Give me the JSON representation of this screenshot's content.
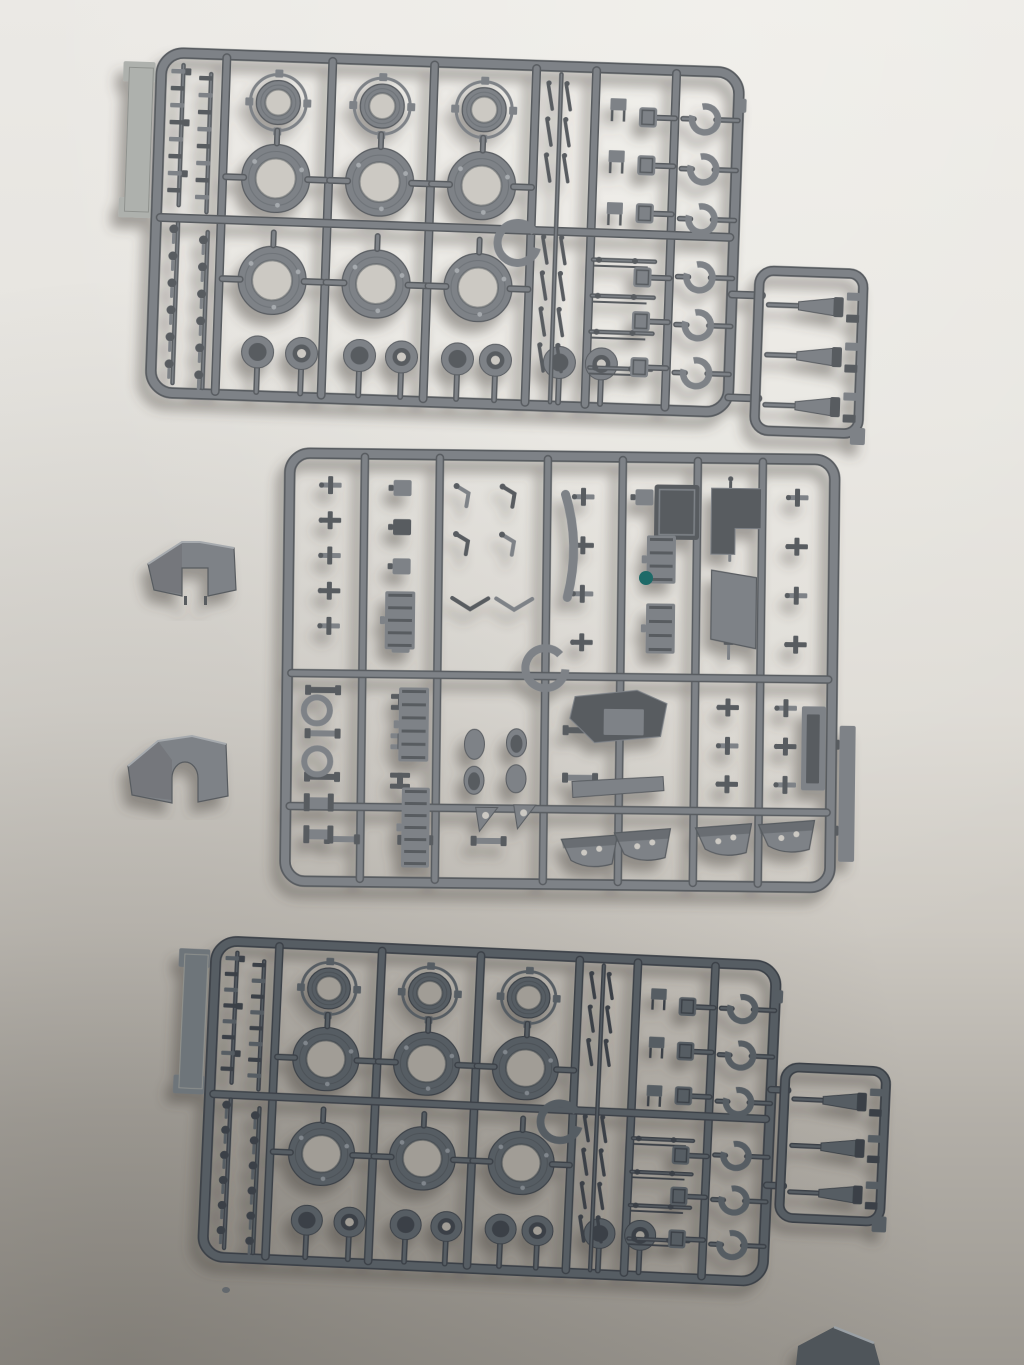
{
  "scene": {
    "subject": "photo of three gray injection-molded model-kit sprues with wheels and small parts, plus two loose mudguard parts, on light paper that darkens toward the bottom",
    "canvas": {
      "width": 1024,
      "height": 1365
    },
    "background": {
      "stops": [
        [
          0,
          "#ebe9e5"
        ],
        [
          0.3,
          "#e6e4df"
        ],
        [
          0.52,
          "#dddad4"
        ],
        [
          0.68,
          "#ccc8c1"
        ],
        [
          0.82,
          "#b3afa8"
        ],
        [
          1,
          "#9c9891"
        ]
      ],
      "corner_shade": "rgba(50,47,42,0.25)",
      "top_light": "rgba(255,255,250,0.30)"
    },
    "palettes": {
      "plastic": {
        "mid": "#7e8287",
        "dark": "#585c61",
        "light": "#a6aaae",
        "hole": "#ccc9c3",
        "tag": "#aeb1ad"
      },
      "plastic_dark": {
        "mid": "#575d63",
        "dark": "#3b4147",
        "light": "#80868c",
        "hole": "#a19d96",
        "tag": "#6e747a"
      }
    },
    "accent_dot": {
      "color": "#1e6a68",
      "cx": 646,
      "cy": 578,
      "r": 7
    },
    "wheel_layout": {
      "frame": [
        12,
        0,
        578,
        340
      ],
      "rx": 22,
      "tag": {
        "x": -20,
        "y": 10,
        "w": 24,
        "h": 156
      },
      "v_runners": [
        77,
        183,
        285,
        387,
        447,
        527
      ],
      "h_runner_y": 165,
      "wheel_cols": [
        130,
        234,
        336
      ],
      "row1": {
        "cy": 46,
        "ro": 22,
        "ri": 13,
        "flange": 28
      },
      "row2": {
        "cy": 122,
        "ro": 34,
        "ri": 20
      },
      "row3": {
        "cy": 224,
        "ro": 34,
        "ri": 20
      },
      "cups": {
        "cy": 296,
        "r": 16,
        "xs": [
          118,
          162,
          220,
          262,
          318,
          356,
          420,
          462
        ]
      },
      "left_bars": {
        "y0": 16,
        "rows": 8,
        "dy": 17
      },
      "ball_joints": {
        "y0": 176,
        "rows": 6,
        "dy": 27
      },
      "lever_rows": [
        30,
        66,
        102,
        184,
        220,
        256,
        292
      ],
      "stand_rows": [
        40,
        92,
        144
      ],
      "rod_rows": [
        192,
        228,
        264,
        300
      ],
      "boxes": {
        "cx": 500,
        "cys": [
          48,
          96,
          144,
          208,
          252,
          298
        ],
        "w": 18,
        "h": 20
      },
      "hubs": {
        "cx": 557,
        "cys": [
          48,
          98,
          148,
          206,
          254,
          302
        ],
        "r": 13
      },
      "center_ring": {
        "cx": 374,
        "cy": 178,
        "r": 20
      }
    },
    "detail_layout": {
      "frame": [
        0,
        0,
        545,
        428
      ],
      "rx": 20,
      "v_runners": [
        75,
        150,
        258,
        333,
        408,
        473
      ],
      "h_runners": [
        220,
        353
      ],
      "scatter": [
        [
          10,
          14,
          62,
          176,
          5,
          1,
          "t"
        ],
        [
          6,
          215,
          60,
          130,
          3,
          1,
          "bar"
        ],
        [
          84,
          14,
          58,
          196,
          5,
          1,
          "plate"
        ],
        [
          84,
          228,
          60,
          118,
          3,
          1,
          "clamp"
        ],
        [
          158,
          16,
          92,
          96,
          2,
          2,
          "arm"
        ],
        [
          160,
          120,
          88,
          58,
          1,
          2,
          "vee"
        ],
        [
          262,
          16,
          64,
          194,
          4,
          1,
          "t"
        ],
        [
          262,
          250,
          64,
          95,
          2,
          1,
          "bar"
        ],
        [
          340,
          14,
          60,
          52,
          1,
          2,
          "plate"
        ],
        [
          412,
          14,
          58,
          196,
          4,
          1,
          "gun"
        ],
        [
          478,
          14,
          60,
          196,
          4,
          1,
          "t"
        ],
        [
          412,
          230,
          116,
          115,
          3,
          2,
          "t"
        ],
        [
          20,
          358,
          220,
          55,
          1,
          3,
          "bar"
        ]
      ],
      "parts": {
        "square_box": [
          365,
          27,
          45,
          55
        ],
        "l_plate": "M422,30 h50 v40 h-26 v26 h-24 z",
        "strip": "M276,38 q16,50 3,103",
        "ladders": [
          [
            97,
            137,
            30,
            58
          ],
          [
            358,
            78,
            29,
            48
          ],
          [
            358,
            146,
            29,
            50
          ],
          [
            112,
            233,
            30,
            74
          ],
          [
            116,
            333,
            28,
            80
          ]
        ],
        "hull_side": "423,112 468,119 468,190 423,181",
        "hex_plate": "288,240 350,233 380,246 374,279 308,286 283,262",
        "hex_inner": [
          317,
          252,
          40,
          26
        ],
        "bar_long": "286,325 377,319 378,333 287,341",
        "open_box": [
          515,
          247,
          24,
          84
        ],
        "open_box_slot": [
          520,
          255,
          13,
          69
        ],
        "rail": [
          553,
          266,
          16,
          136
        ],
        "ring_center": [
          258,
          212,
          20
        ],
        "rings_left": [
          [
            30,
            257,
            13
          ],
          [
            31,
            308,
            13
          ]
        ],
        "domes": [
          [
            188,
            289,
            10,
            15,
            0
          ],
          [
            230,
            287,
            10,
            14,
            1
          ],
          [
            188,
            325,
            10,
            14,
            1
          ],
          [
            230,
            323,
            10,
            14,
            0
          ]
        ],
        "gussets": [
          "190,352 212,352 194,376",
          "228,349 250,349 232,373"
        ],
        "fenders": [
          [
            306,
            395
          ],
          [
            359,
            388
          ],
          [
            440,
            382
          ],
          [
            503,
            378
          ]
        ],
        "spools": [
          [
            18,
            340,
            30,
            18
          ],
          [
            18,
            372,
            30,
            18
          ]
        ]
      }
    },
    "sprues": [
      {
        "name": "wheel-sprue-top",
        "type": "wheel",
        "tx": 150,
        "ty": 52,
        "rot": 2.0,
        "sx": 1,
        "sy": 1,
        "palette": "plastic",
        "satellite": {
          "x": 617,
          "y": 197,
          "w": 104,
          "h": 160
        }
      },
      {
        "name": "detail-sprue-middle",
        "type": "detail",
        "tx": 290,
        "ty": 453,
        "rot": 0.7,
        "sx": 1,
        "sy": 1,
        "palette": "plastic"
      },
      {
        "name": "wheel-sprue-bottom",
        "type": "wheel",
        "tx": 205,
        "ty": 940,
        "rot": 2.6,
        "sx": 0.97,
        "sy": 0.93,
        "palette": "plastic_dark",
        "satellite": {
          "x": 604,
          "y": 108,
          "w": 104,
          "h": 162
        }
      }
    ],
    "loose_parts": [
      {
        "name": "loose-mudguard-upper",
        "body": "M148,564 L182,542 L200,542 L234,548 L236,590 L208,596 L208,568 L182,568 L182,596 L154,590 Z",
        "facet": "148,564 182,542 182,594 154,590",
        "edge": "M148,564 L182,542 L200,542 L234,548",
        "pins": [
          [
            184,
            596,
            3,
            9
          ],
          [
            204,
            596,
            3,
            9
          ]
        ]
      },
      {
        "name": "loose-mudguard-lower",
        "body": "M128,766 L158,741 L192,736 L226,744 L228,796 L198,802 L198,778 A13,16 0 0 0 172,778 L172,803 L132,795 Z",
        "facet": "128,766 158,741 172,760 172,800 132,795",
        "edge": "M128,766 L158,741 L192,736 L226,744",
        "pins": []
      }
    ],
    "stray_objects": {
      "corner_part": {
        "points": "798,1346 834,1327 874,1343 880,1365 796,1365",
        "fill": "#50555a",
        "edge": "#9aa0a5"
      },
      "speck": {
        "cx": 226,
        "cy": 1290,
        "rx": 4,
        "ry": 3,
        "fill": "#63686d"
      }
    }
  }
}
